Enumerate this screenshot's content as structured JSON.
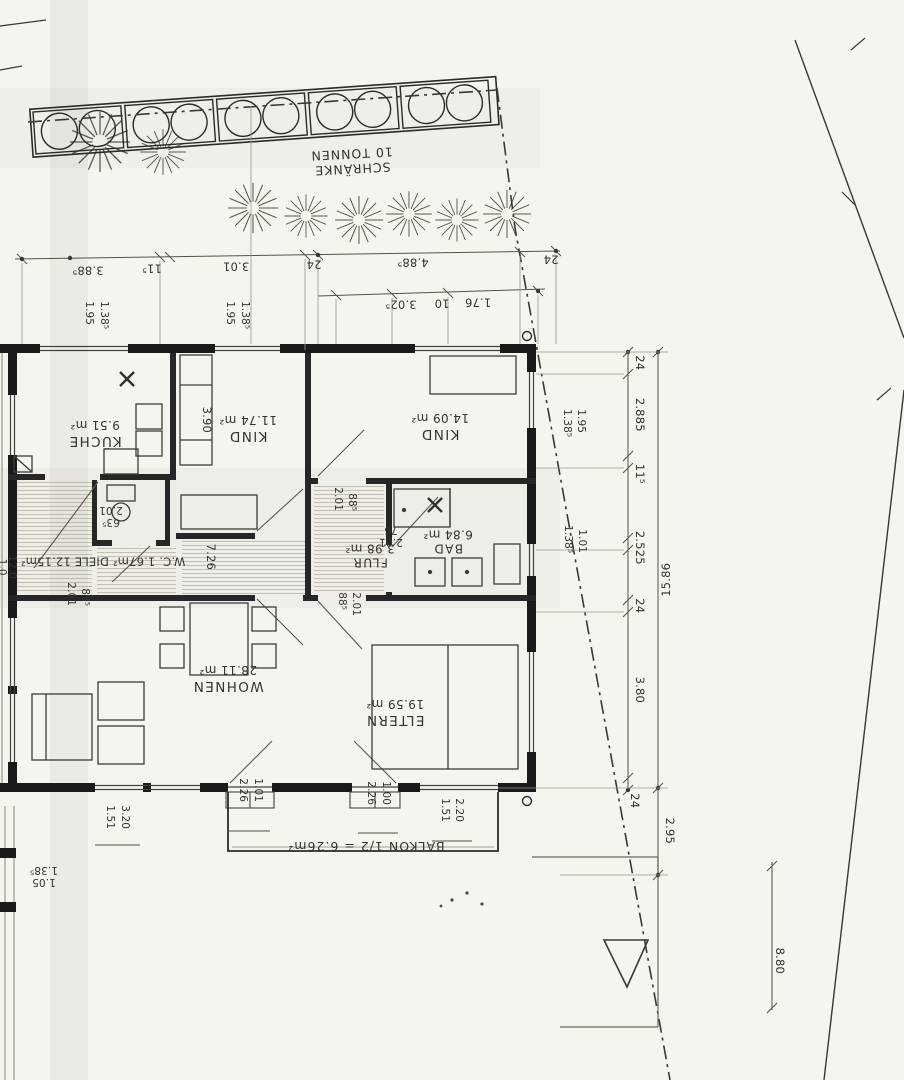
{
  "site": {
    "bins": {
      "line1": "SCHRÄNKE",
      "line2": "10 TONNEN"
    }
  },
  "rooms": {
    "kueche": {
      "name": "KÜCHE",
      "area": "9.51 m²"
    },
    "kind1": {
      "name": "KIND",
      "area": "11.74 m²"
    },
    "kind2": {
      "name": "KIND",
      "area": "14.09 m²"
    },
    "wc_diele": {
      "label": "W.C. 1.67m²   DIELE 12.15m²"
    },
    "flur": {
      "name": "FLUR",
      "area": "3.98 m²"
    },
    "bad": {
      "name": "BAD",
      "area": "6.84 m²"
    },
    "wohnen": {
      "name": "WOHNEN",
      "area": "28.11 m²"
    },
    "eltern": {
      "name": "ELTERN",
      "area": "19.59 m²"
    },
    "balkon": {
      "label": "BALKON 1/2 = 6.26m²"
    }
  },
  "dims": {
    "t1_1": "3.88⁵",
    "t1_2": "11⁵",
    "t1_3": "3.01",
    "t1_4": "24",
    "t1_5": "4.88⁵",
    "t1_6": "24",
    "t2_1": "3.02⁵",
    "t2_2": "10",
    "t2_3": "1.76",
    "p1a": "1.95",
    "p1b": "1.38⁵",
    "p2a": "1.95",
    "p2b": "1.38⁵",
    "r_1": "24",
    "r_2": "2.885",
    "r_3": "11⁵",
    "r_4": "2.525",
    "r_5": "24",
    "r_6": "3.80",
    "r_7": "24",
    "r_total": "15.86",
    "r_balkon": "2.95",
    "r_plot": "8.80",
    "rp1a": "1.38⁵",
    "rp1b": "1.95",
    "rp2a": "1.38⁵",
    "rp2b": "1.01",
    "kind1_depth": "3.90",
    "hall_len": "7.26",
    "cp1a": "2.01",
    "cp1b": "88⁵",
    "cp2a": "2.01",
    "cp2b": "88⁵",
    "cp3a": "88⁵",
    "cp3b": "2.01",
    "flur_door_a": "2.01",
    "flur_door_b": "76",
    "wc_door_a": "63⁵",
    "wc_door_b": "2.01",
    "b1a": "1.51",
    "b1b": "3.20",
    "b2a": "2.26",
    "b2b": "1.01",
    "b3a": "2.26",
    "b3b": "1.00",
    "b4a": "1.51",
    "b4b": "2.20",
    "b5a": "1.05",
    "b5b": "1.38⁵",
    "edge_a": "1.0",
    "edge_b": "12.0"
  }
}
